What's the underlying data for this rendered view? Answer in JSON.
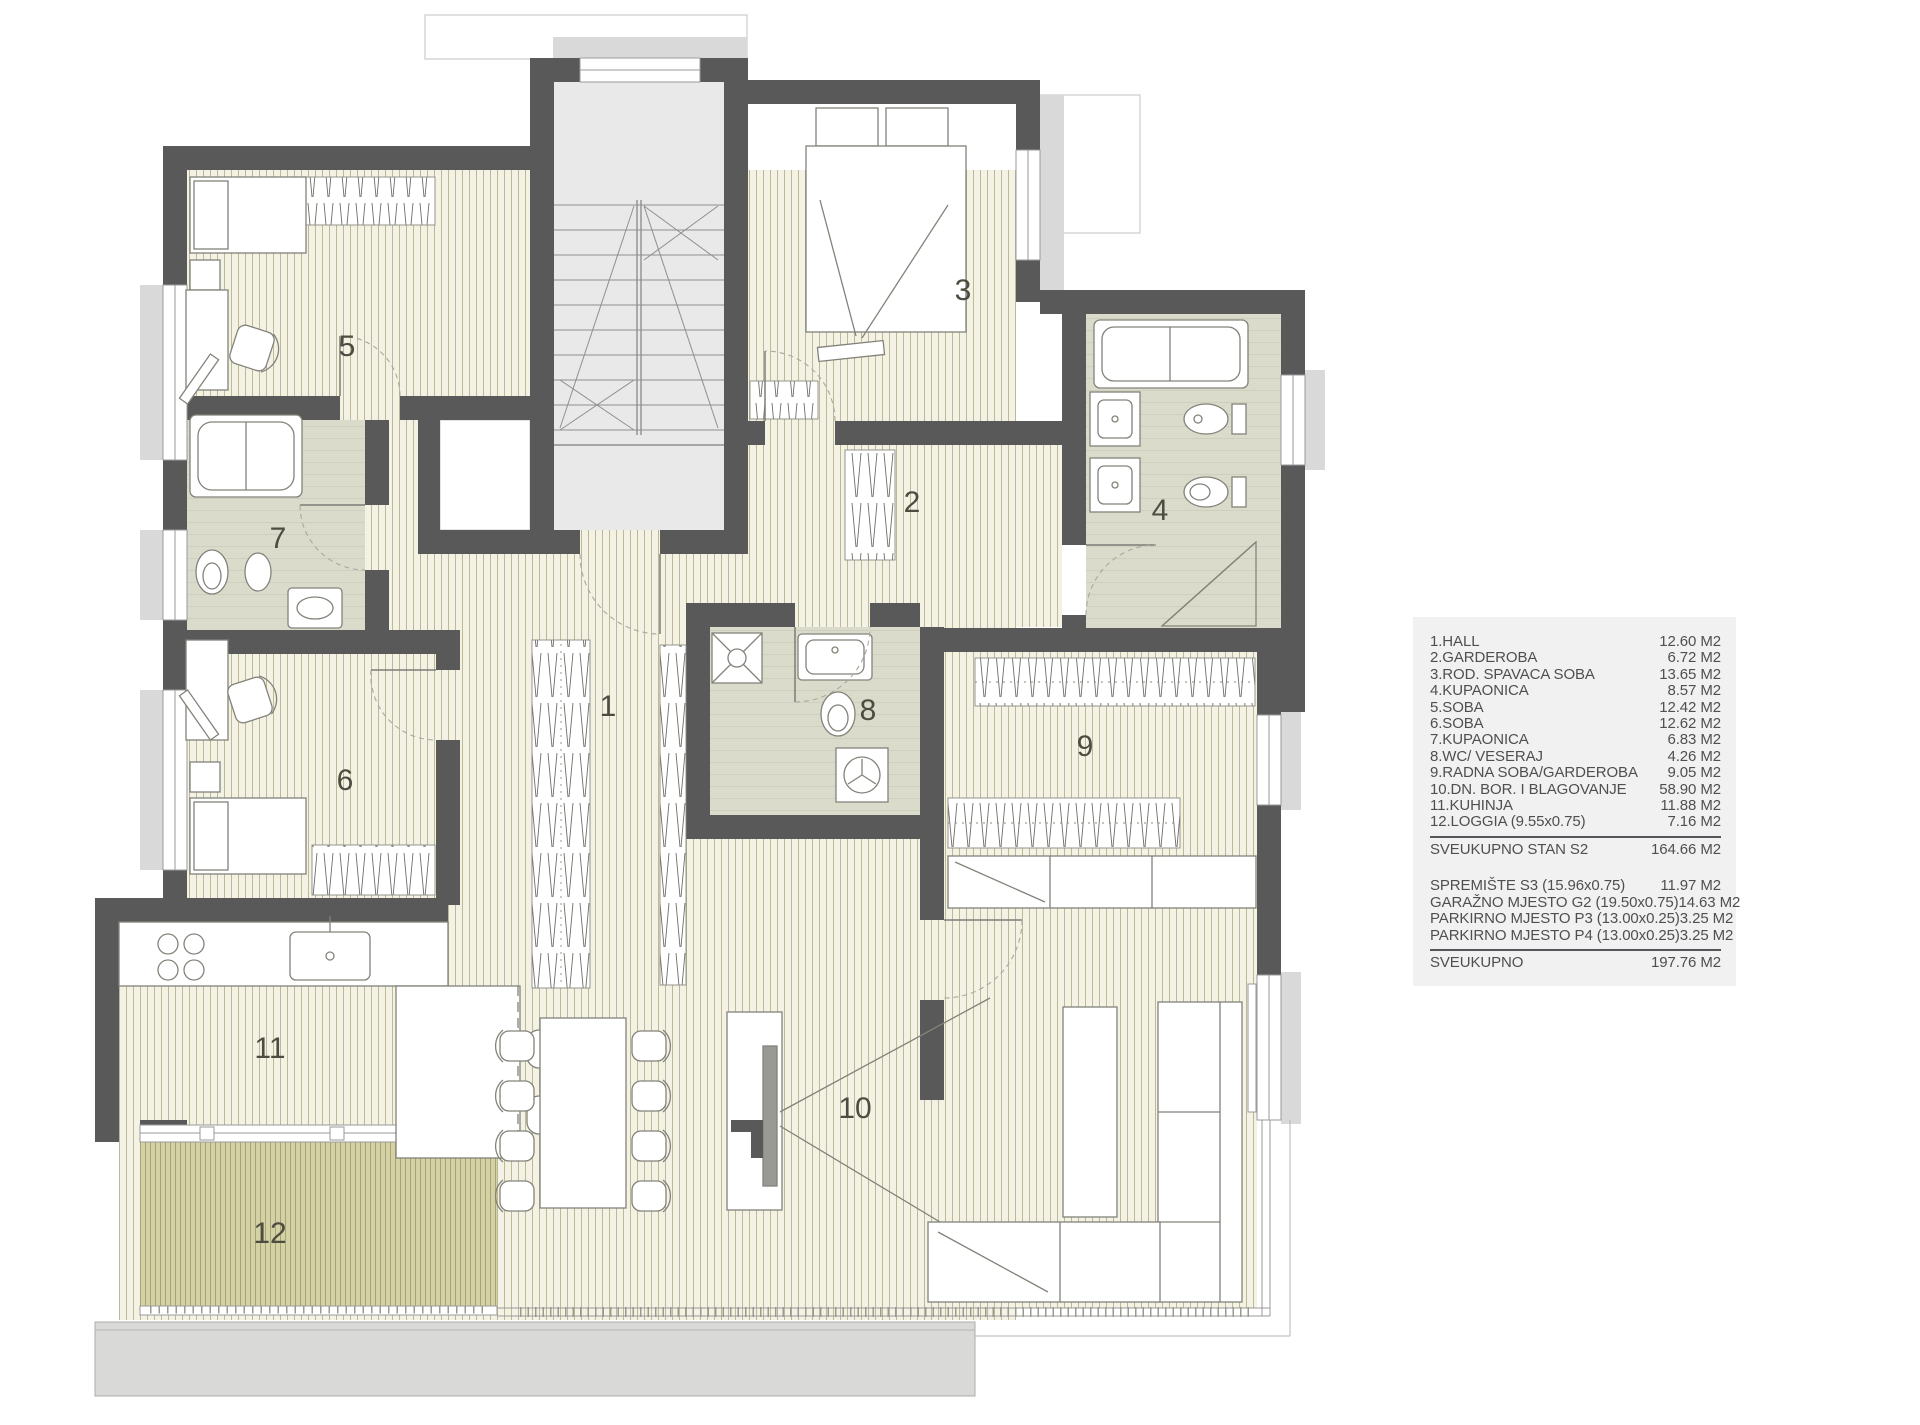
{
  "plan": {
    "room_labels": [
      "1",
      "2",
      "3",
      "4",
      "5",
      "6",
      "7",
      "8",
      "9",
      "10",
      "11",
      "12"
    ]
  },
  "legend": {
    "rows": [
      {
        "label": "1.HALL",
        "area": "12.60 M2"
      },
      {
        "label": "2.GARDEROBA",
        "area": "6.72 M2"
      },
      {
        "label": "3.ROD. SPAVACA SOBA",
        "area": "13.65 M2"
      },
      {
        "label": "4.KUPAONICA",
        "area": "8.57 M2"
      },
      {
        "label": "5.SOBA",
        "area": "12.42 M2"
      },
      {
        "label": "6.SOBA",
        "area": "12.62 M2"
      },
      {
        "label": "7.KUPAONICA",
        "area": "6.83 M2"
      },
      {
        "label": "8.WC/ VESERAJ",
        "area": "4.26 M2"
      },
      {
        "label": "9.RADNA SOBA/GARDEROBA",
        "area": "9.05 M2"
      },
      {
        "label": "10.DN. BOR. I BLAGOVANJE",
        "area": "58.90 M2"
      },
      {
        "label": "11.KUHINJA",
        "area": "11.88 M2"
      },
      {
        "label": "12.LOGGIA (9.55x0.75)",
        "area": "7.16 M2"
      }
    ],
    "subtotal": {
      "label": "SVEUKUPNO STAN S2",
      "area": "164.66 M2"
    },
    "extras": [
      {
        "label": "SPREMIŠTE S3 (15.96x0.75)",
        "area": "11.97 M2"
      },
      {
        "label": "GARAŽNO MJESTO G2 (19.50x0.75)",
        "area": "14.63 M2"
      },
      {
        "label": "PARKIRNO MJESTO P3 (13.00x0.25)",
        "area": "3.25 M2"
      },
      {
        "label": "PARKIRNO MJESTO P4 (13.00x0.25)",
        "area": "3.25 M2"
      }
    ],
    "total": {
      "label": "SVEUKUPNO",
      "area": "197.76 M2"
    }
  },
  "colors": {
    "wall": "#59595a",
    "wood_floor": "#f4f2e5",
    "wood_line": "#bcba94",
    "bath_floor": "#dbdbcc",
    "loggia_floor": "#d4d1a4",
    "loggia_line": "#a6a377",
    "stair_gray": "#e9e9e9",
    "sill_gray": "#d9d9d9",
    "terrace_gray": "#d9d9d7",
    "furniture_stroke": "#83837a",
    "label_text": "#4c4c40",
    "legend_bg": "#f1f1f1",
    "legend_text": "#4f4f52"
  }
}
